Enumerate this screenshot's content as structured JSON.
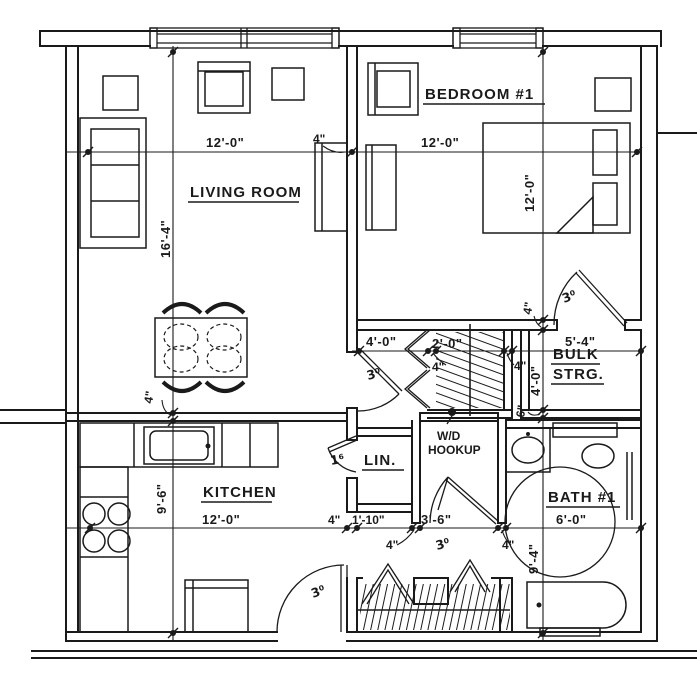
{
  "palette": {
    "bg": "#ffffff",
    "ink": "#1a1a1a"
  },
  "rooms": {
    "living_room": "LIVING ROOM",
    "bedroom": "BEDROOM #1",
    "kitchen": "KITCHEN",
    "bath": "BATH #1",
    "bulk1": "BULK",
    "bulk2": "STRG.",
    "linen": "LIN.",
    "wd1": "W/D",
    "wd2": "HOOKUP"
  },
  "dims": {
    "twelve": "12'-0\"",
    "lr_h": "16'-4\"",
    "kit_h": "9'-6\"",
    "bath_h": "9'-4\"",
    "bath_w": "6'-0\"",
    "bulk_w": "5'-4\"",
    "bulk_h": "4'-0\"",
    "hall": "4'-0\"",
    "closet": "2'-0\"",
    "lin": "1'-10\"",
    "hall2": "3'-6\"",
    "wall4": "4\"",
    "wall6": "6\""
  },
  "doors": {
    "d30": "3⁰",
    "d16": "1⁶"
  }
}
